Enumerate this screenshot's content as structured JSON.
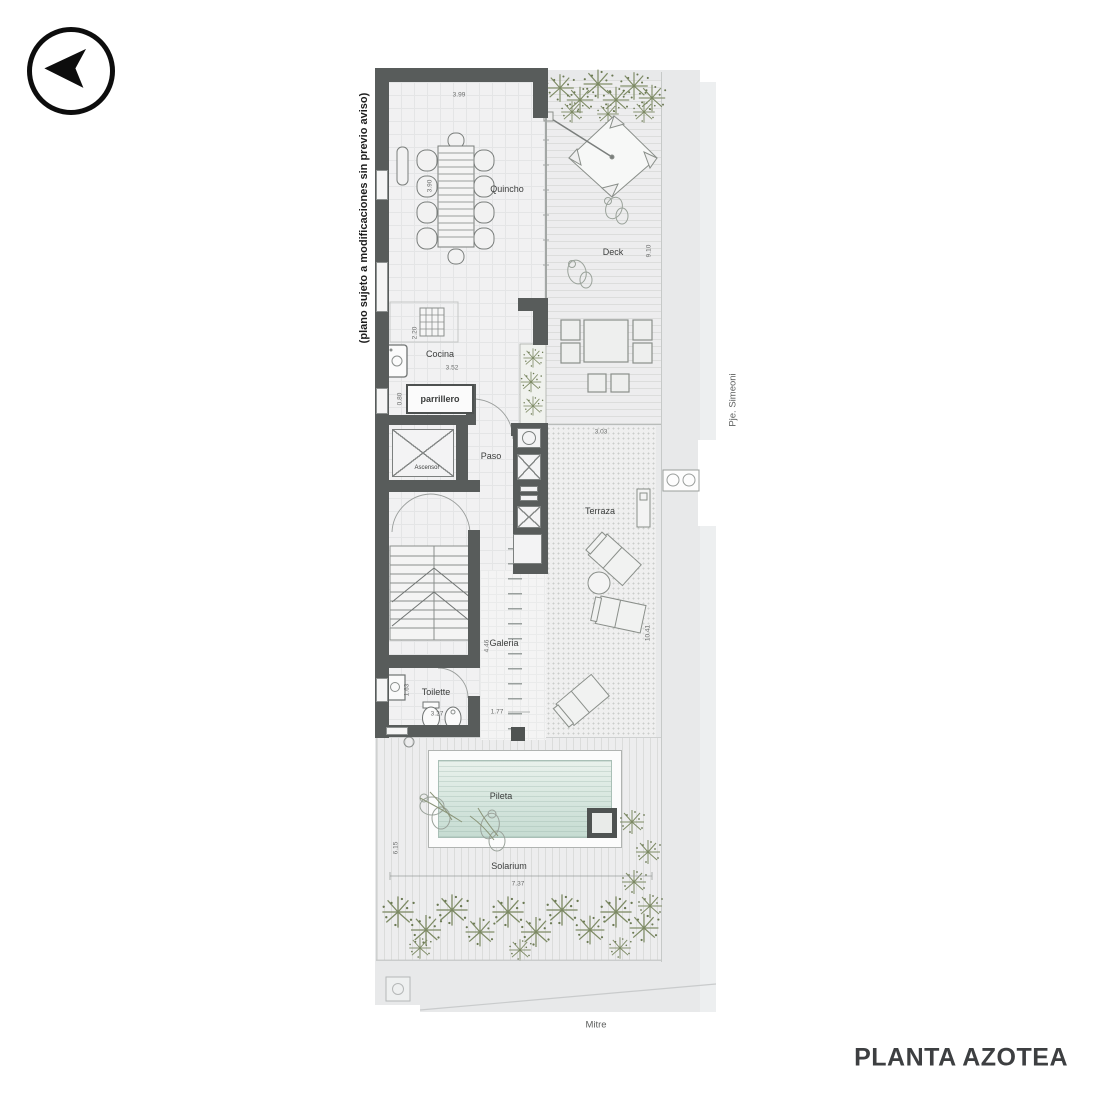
{
  "title": "PLANTA AZOTEA",
  "disclaimer": "(plano sujeto a modificaciones sin previo aviso)",
  "streets": {
    "side": "Pje. Simeoni",
    "bottom": "Mitre"
  },
  "labels": {
    "quincho": "Quincho",
    "deck": "Deck",
    "cocina": "Cocina",
    "parrillero": "parrillero",
    "ascensor": "Ascensor",
    "paso": "Paso",
    "terraza": "Terraza",
    "galeria": "Galeria",
    "toilette": "Toilette",
    "pileta": "Pileta",
    "solarium": "Solarium"
  },
  "dims": {
    "quincho_w": "3.99",
    "quincho_h": "3.90",
    "deck_h": "9.10",
    "cocina_h": "2.20",
    "cocina_w": "3.52",
    "parrillero_h": "0.80",
    "terraza_w": "3.03",
    "terraza_h": "10.41",
    "galeria_h": "4.46",
    "galeria_w": "1.77",
    "toilette_h": "1.63",
    "toilette_w": "3.27",
    "solarium_h": "6.15",
    "solarium_w": "7.37"
  },
  "colors": {
    "wall": "#585c5b",
    "lot": "#e8e9ea",
    "pool": "#cfe2d8",
    "plant": "#7d8a64",
    "title_text": "#3d3f41"
  }
}
